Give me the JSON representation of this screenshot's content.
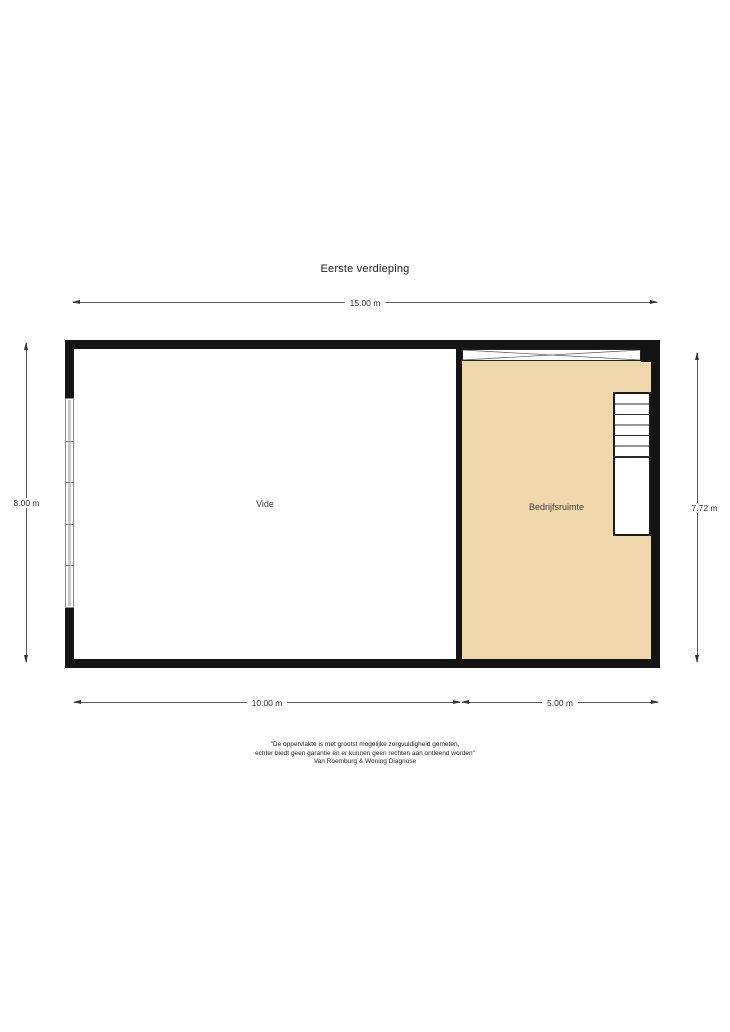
{
  "title": "Eerste verdieping",
  "floor_plan": {
    "rooms": [
      {
        "name": "Vide",
        "fill": "#FFFFFF"
      },
      {
        "name": "Bedrijfsruimte",
        "fill": "#F0D8AC"
      }
    ],
    "wall_color": "#141414",
    "window_glass_color": "#C9C9C9",
    "features": [
      "window-left-wall",
      "glass-strip-top-wall",
      "staircase-top-right"
    ]
  },
  "dimensions": {
    "top_width": "15.00 m",
    "left_height": "8.00 m",
    "right_height": "7.72 m",
    "bottom_left_width": "10.00 m",
    "bottom_right_width": "5.00 m"
  },
  "footer": {
    "line1": "\"De oppervlakte is met grootst mogelijke zorgvuldigheid gemeten,",
    "line2": "echter biedt geen garantie en er kunnen geen rechten aan ontleend worden\"",
    "line3": "Van Roemburg & Woning Diagnose"
  }
}
